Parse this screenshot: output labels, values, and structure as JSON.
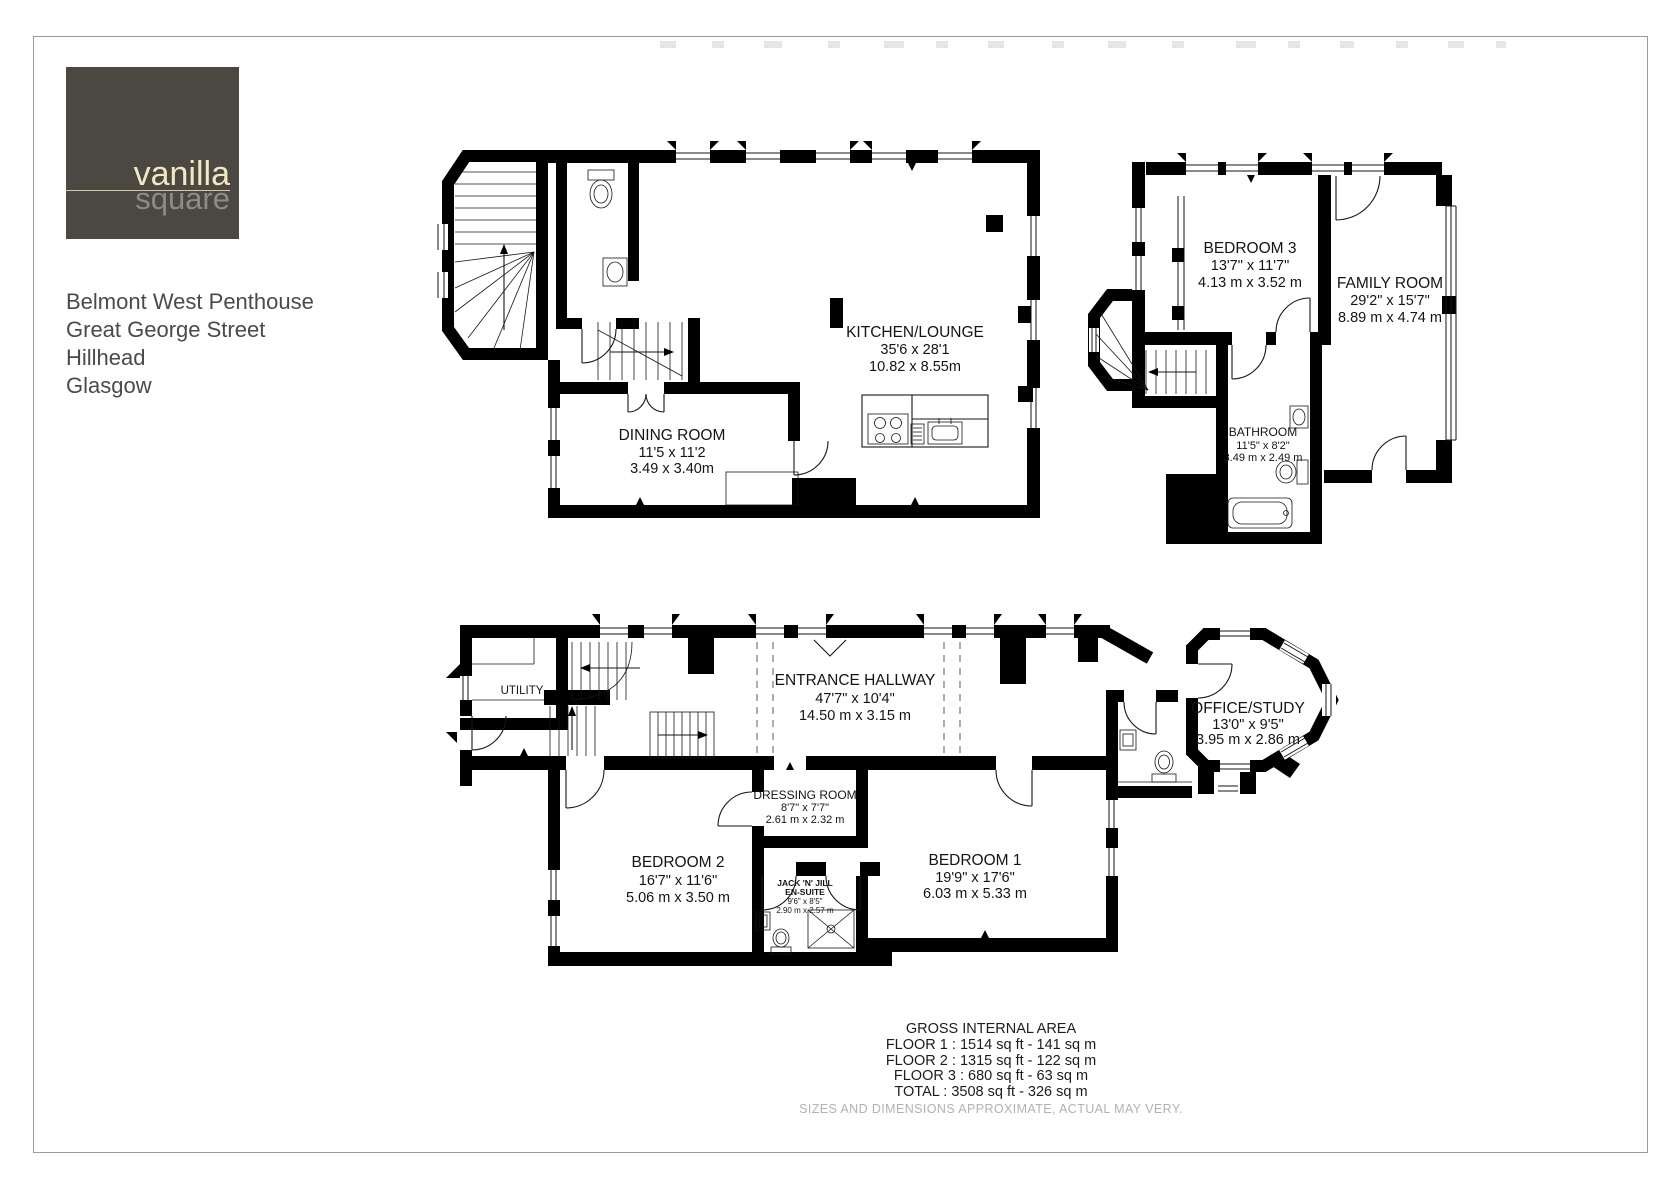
{
  "page": {
    "logo": {
      "word1": "vanilla",
      "word2": "square",
      "bg_color": "#4b4842",
      "word1_color": "#efe8c4",
      "word2_color": "#8b8b89"
    },
    "address": {
      "line1": "Belmont West Penthouse",
      "line2": "Great George Street",
      "line3": "Hillhead",
      "line4": "Glasgow"
    }
  },
  "floors": {
    "floor2": {
      "kitchen_lounge": {
        "name": "KITCHEN/LOUNGE",
        "imperial": "35'6 x 28'1",
        "metric": "10.82 x 8.55m"
      },
      "dining_room": {
        "name": "DINING ROOM",
        "imperial": "11'5 x 11'2",
        "metric": "3.49 x 3.40m"
      }
    },
    "floor3": {
      "bedroom3": {
        "name": "BEDROOM 3",
        "imperial": "13'7\" x 11'7\"",
        "metric": "4.13 m x 3.52 m"
      },
      "family_room": {
        "name": "FAMILY ROOM",
        "imperial": "29'2\" x 15'7\"",
        "metric": "8.89 m x 4.74 m"
      },
      "bathroom": {
        "name": "BATHROOM",
        "imperial": "11'5\" x 8'2\"",
        "metric": "3.49 m x 2.49 m"
      }
    },
    "floor1": {
      "utility": {
        "name": "UTILITY"
      },
      "entrance_hallway": {
        "name": "ENTRANCE HALLWAY",
        "imperial": "47'7\" x 10'4\"",
        "metric": "14.50 m x 3.15 m"
      },
      "office_study": {
        "name": "OFFICE/STUDY",
        "imperial": "13'0\" x 9'5\"",
        "metric": "3.95 m x 2.86 m"
      },
      "dressing_room": {
        "name": "DRESSING ROOM",
        "imperial": "8'7\" x 7'7\"",
        "metric": "2.61 m x 2.32 m"
      },
      "bedroom2": {
        "name": "BEDROOM 2",
        "imperial": "16'7\" x 11'6\"",
        "metric": "5.06 m x 3.50 m"
      },
      "bedroom1": {
        "name": "BEDROOM 1",
        "imperial": "19'9\" x 17'6\"",
        "metric": "6.03 m x 5.33 m"
      },
      "jack_n_jill": {
        "name": "JACK 'N' JILL",
        "name2": "EN-SUITE",
        "imperial": "9'6\" x 8'5\"",
        "metric": "2.90 m x 2.57 m"
      }
    }
  },
  "summary": {
    "title": "GROSS INTERNAL AREA",
    "floor1": "FLOOR 1 : 1514 sq ft - 141 sq m",
    "floor2": "FLOOR 2 : 1315 sq ft - 122 sq m",
    "floor3": "FLOOR 3 : 680 sq ft - 63 sq m",
    "total": "TOTAL : 3508 sq ft - 326 sq m",
    "disclaimer": "SIZES AND DIMENSIONS APPROXIMATE, ACTUAL MAY VERY."
  }
}
